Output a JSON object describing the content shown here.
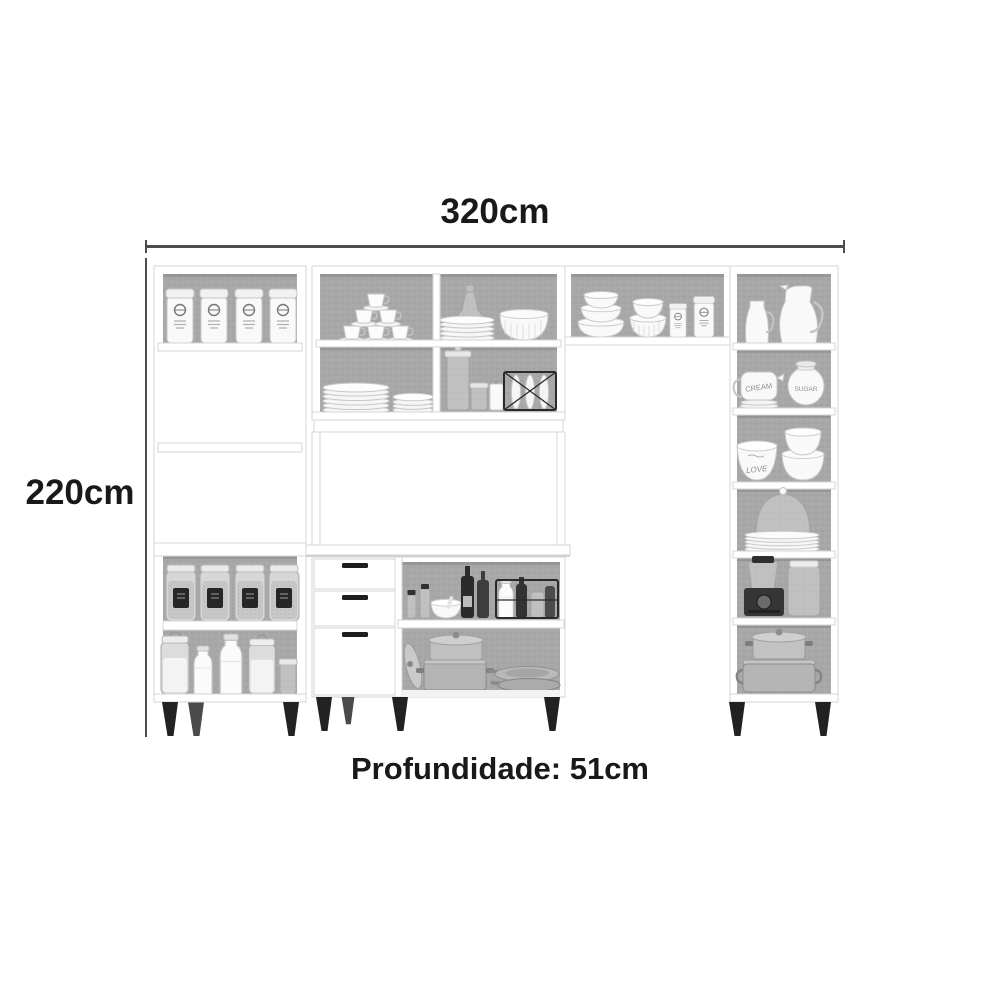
{
  "image_type": "kitchen cabinet product dimension illustration",
  "dimensions": {
    "width_label": "320cm",
    "height_label": "220cm",
    "depth_label": "Profundidade: 51cm"
  },
  "furniture": {
    "description": "white modular kitchen cabinet set with open shelves and gray back panels",
    "tableware_labels": {
      "cream": "CREAM",
      "sugar": "SUGAR",
      "love": "LOVE"
    },
    "modules": [
      "left tall cabinet: clamp canisters, two open shelves, pantry jars, milk bottles",
      "upper hutch: cup pyramid, decanter with plates, ribbed bowls, plate stacks, glass jars, candle, wire plate rack",
      "base cabinet: two drawers and a door, spice and wine bottles, bottle basket, pots and pans",
      "bridge shelf: stacked bowls, ruffled bowls, two canisters",
      "right tall cabinet: pitchers, cream and sugar set, bowls, cake dome on plates, blender, glass jug, stock pots"
    ]
  },
  "colors": {
    "background": "#ffffff",
    "dimension_text": "#191919",
    "dimension_line": "#4d4d4d",
    "cabinet_white": "#ffffff",
    "back_panel_gray": "#a8a8a8",
    "leg_black": "#222222",
    "appliance_dark": "#353535",
    "cookware_gray": "#b7b7b7"
  }
}
